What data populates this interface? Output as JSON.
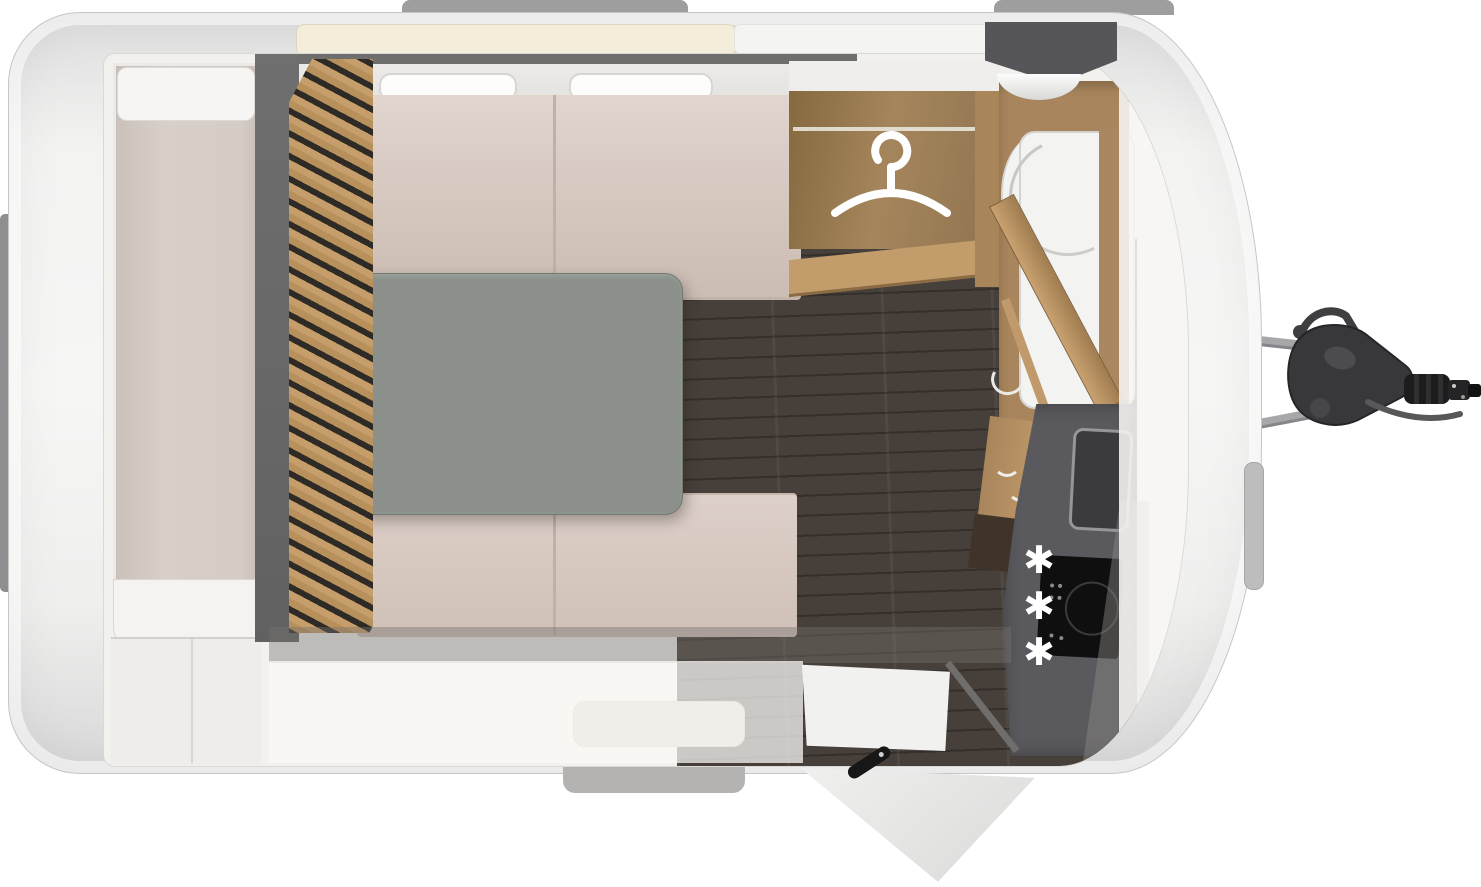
{
  "app": {
    "name": "caravan-floorplan",
    "view": "top-down"
  },
  "hob": {
    "marks": [
      "✱",
      "✱",
      "✱"
    ]
  },
  "icons": {
    "wardrobe": "hanger-icon",
    "hob_burners": "asterisk-burner-marks"
  },
  "colors": {
    "body_shell": "#f3f3f2",
    "interior_floor": "#f2f1ee",
    "wood": "#b68f60",
    "wood_slats": "#c59e6b",
    "dark_floor": "#463f3a",
    "cushion": "#d9cac2",
    "table": "#8b908a",
    "counter": "#5a595d",
    "hob": "#0f0f10",
    "divider_wall": "#696969",
    "hitch": "#38383b",
    "mark_white": "#ffffff"
  },
  "rooms": [
    {
      "id": "rear-storage"
    },
    {
      "id": "dinette"
    },
    {
      "id": "wardrobe"
    },
    {
      "id": "washroom"
    },
    {
      "id": "kitchen"
    },
    {
      "id": "entry-door"
    }
  ],
  "exterior": [
    {
      "id": "roof-rail-left"
    },
    {
      "id": "roof-rail-right"
    },
    {
      "id": "rear-bumper"
    },
    {
      "id": "entry-step"
    },
    {
      "id": "grab-handle"
    },
    {
      "id": "tow-hitch"
    }
  ]
}
